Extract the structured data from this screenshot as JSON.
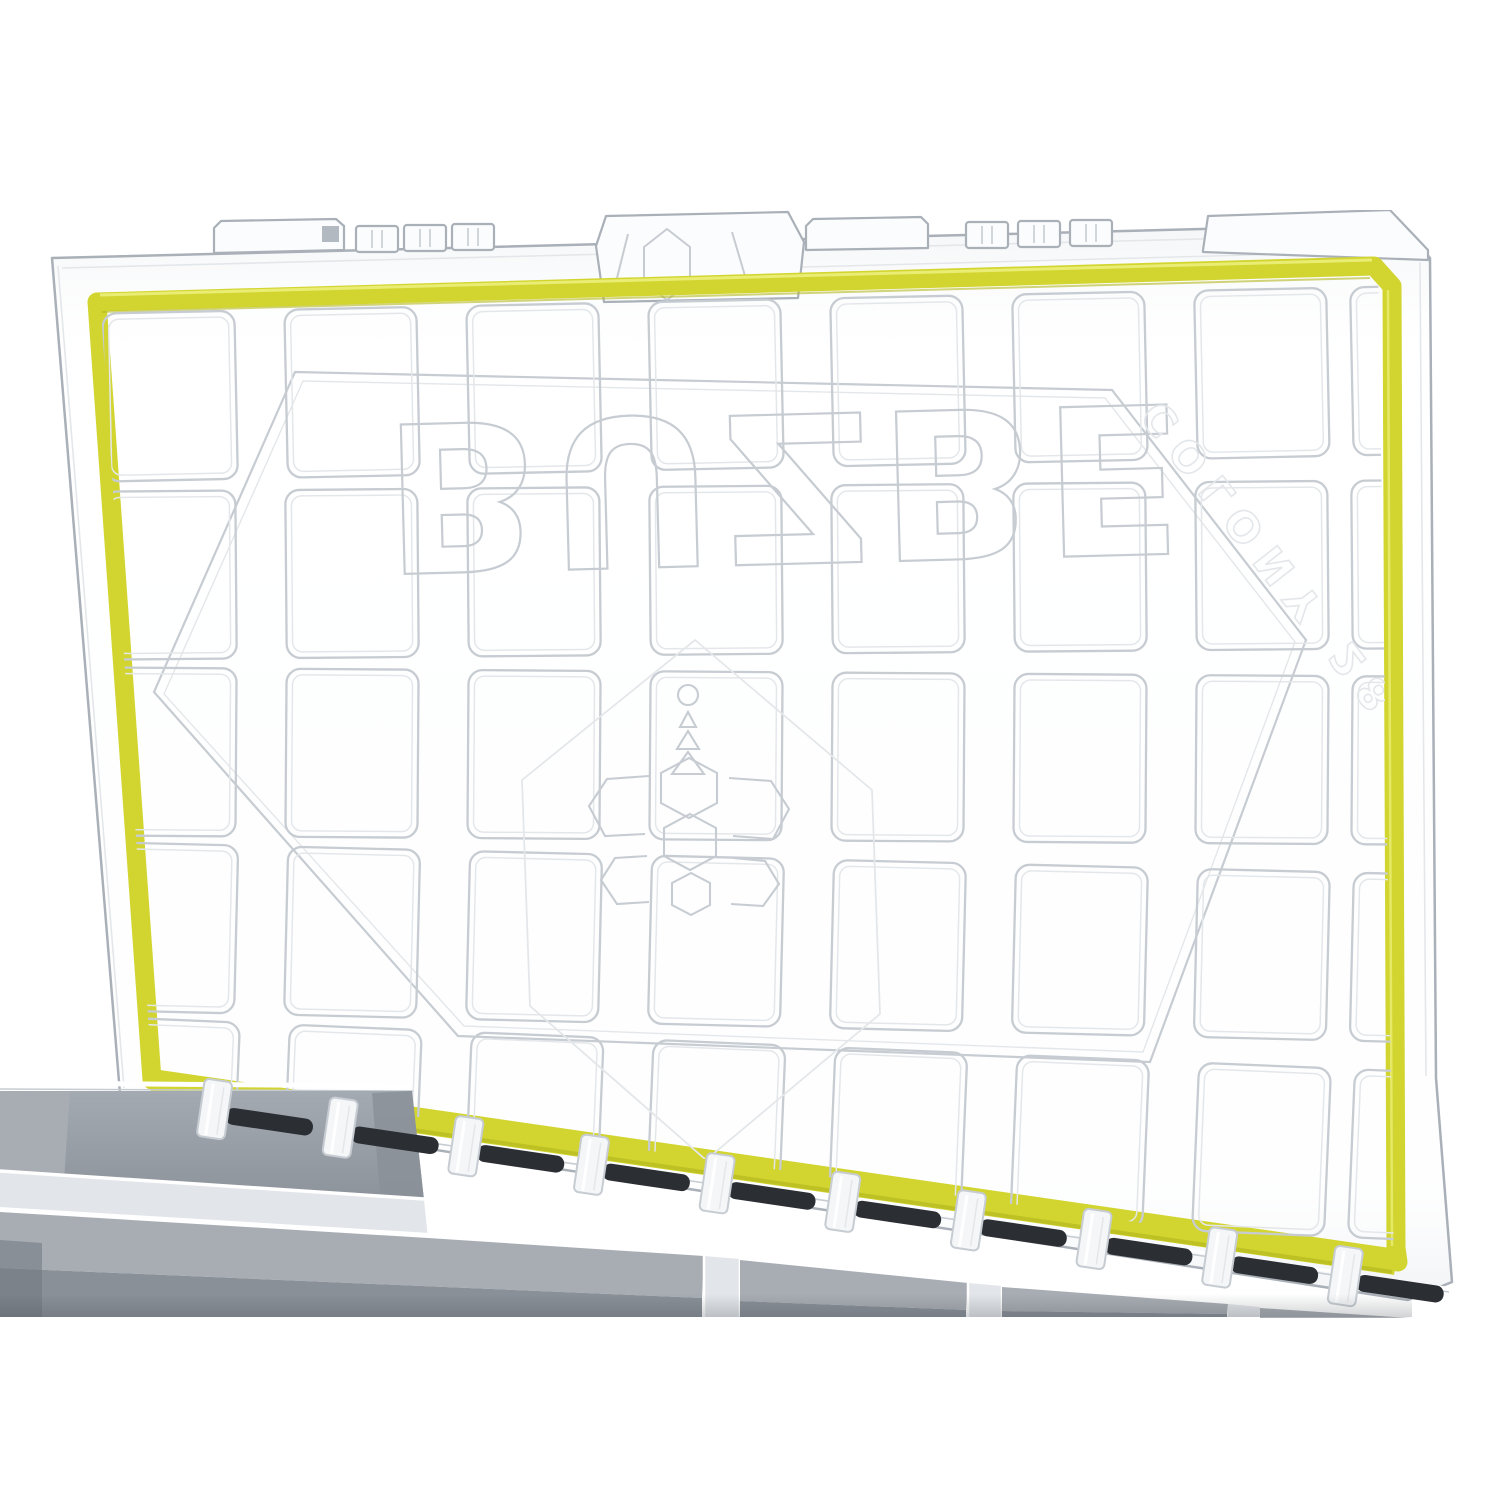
{
  "photo": {
    "subject": "Open clear-lid modular tackle box with yellow waterproof gasket seal, molded lid compartment grid, hexagon bee logo, hinge row and gray storage bins",
    "background_color": "#ffffff"
  },
  "embossing": {
    "brand": "BUZBE",
    "model": "COLONY 28",
    "appearance": "faint molded outline letters seen flipped through the transparent lid"
  },
  "palette": {
    "white": "#ffffff",
    "plastic": "#f7f9fa",
    "line": "#c6ccd2",
    "line-strong": "#aab0b8",
    "line-faint": "#e4e7ea",
    "gasket": "#d2d52f",
    "gasket-shade": "#b4b81f",
    "gasket-highlight": "#eaed74",
    "pin": "#2b2e33",
    "bin": "#9aa0a8",
    "bin-light": "#a8adb4",
    "bin-dark": "#8a9098",
    "bin-deep": "#70767e",
    "divider": "#e2e5e9"
  },
  "lid": {
    "emboss_grid_rows": 5,
    "emboss_grid_cols": 8,
    "latch_tab_groups": 4,
    "hinge_unit_count": 10
  },
  "bins": {
    "visible_count": 5,
    "material_color": "#9aa0a8"
  }
}
